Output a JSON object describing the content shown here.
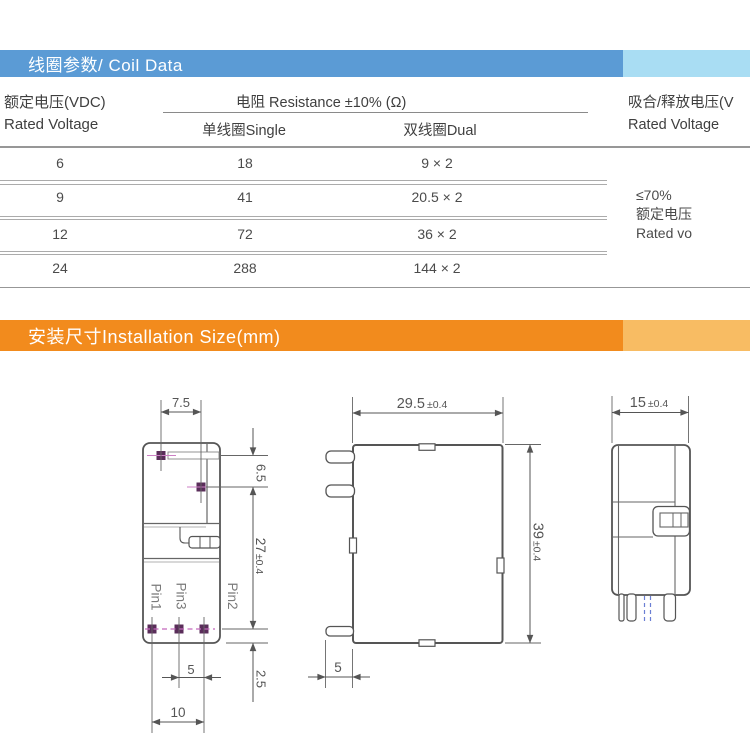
{
  "coil_section": {
    "title": "线圈参数/ Coil Data",
    "table": {
      "voltage_header_zh": "额定电压(VDC)",
      "voltage_header_en": "Rated Voltage",
      "resistance_header": "电阻 Resistance ±10% (Ω)",
      "single_header": "单线圈Single",
      "dual_header": "双线圈Dual",
      "pickup_header_zh": "吸合/释放电压(V",
      "pickup_header_en": "Rated Voltage",
      "rows": [
        {
          "voltage": "6",
          "single": "18",
          "dual": "9 × 2"
        },
        {
          "voltage": "9",
          "single": "41",
          "dual": "20.5 × 2"
        },
        {
          "voltage": "12",
          "single": "72",
          "dual": "36 × 2"
        },
        {
          "voltage": "24",
          "single": "288",
          "dual": "144 × 2"
        }
      ],
      "pickup_note_line1": "≤70%",
      "pickup_note_line2": "额定电压",
      "pickup_note_line3": "Rated vo"
    }
  },
  "install_section": {
    "title": "安装尺寸Installation Size(mm)",
    "dims": {
      "top_pitch": "7.5",
      "coil_pin_offset": "6.5",
      "pin_span_value": "27",
      "pin_span_tol": "±0.4",
      "pin1": "Pin1",
      "pin2": "Pin2",
      "pin3": "Pin3",
      "pin_pitch": "5",
      "pin_row_width": "10",
      "bottom_offset": "2.5",
      "body_width_value": "29.5",
      "body_width_tol": "±0.4",
      "body_height_value": "39",
      "body_height_tol": "±0.4",
      "body_depth_value": "15",
      "body_depth_tol": "±0.4",
      "front_pin_length": "5"
    }
  },
  "colors": {
    "header_blue": "#5b9bd5",
    "header_blue_light": "#a9ddf3",
    "header_orange": "#f28b1d",
    "header_orange_light": "#f8bc63",
    "pin_marker_purple": "#5a2d5a",
    "pin_centerline_magenta": "#c468bc",
    "hidden_pin_blue": "#6b7fd4"
  }
}
